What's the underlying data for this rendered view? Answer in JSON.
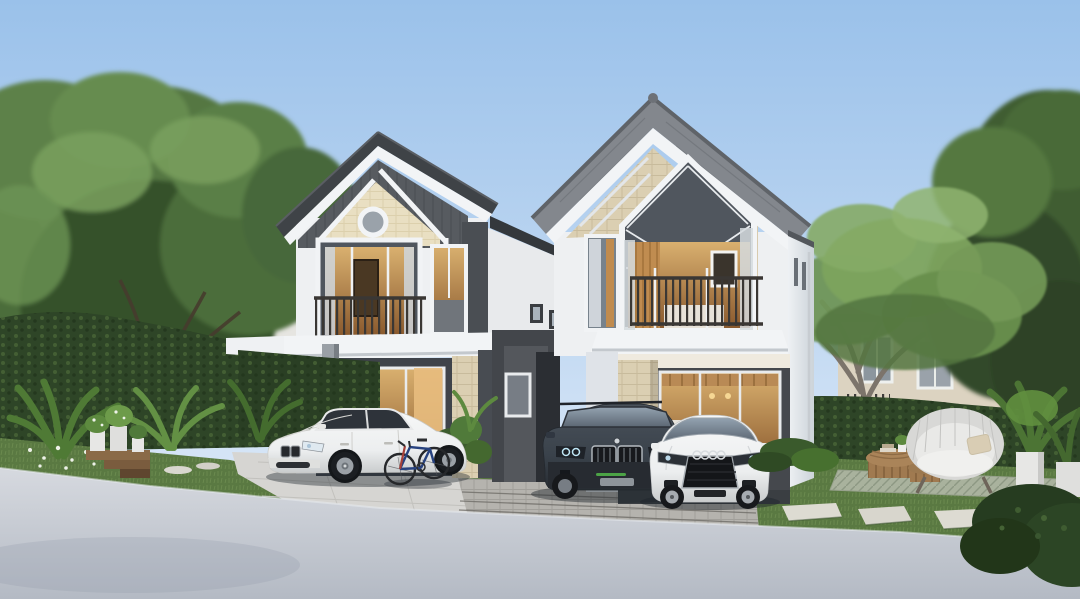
{
  "scene": {
    "title": "Two-storey modern houses — exterior architectural render",
    "setting": "Residential project visualisation at soft dusk light, clear pale-blue sky",
    "houses": [
      {
        "id": "left-house",
        "storeys": 2,
        "roof": "charcoal gable roof with white fascia",
        "gable_accent": "cream shingle panel with round porthole window",
        "features": [
          "second-floor balcony with dark railing",
          "white carport canopy",
          "glass sliding doors with warm interior light",
          "tan tile accent column"
        ]
      },
      {
        "id": "right-house",
        "storeys": 2,
        "roof": "grey tile gable roof with white fascia and ridge caps",
        "gable_accent": "tan brick gable with full-height pentagon feature window",
        "features": [
          "second-floor balcony with dark railing",
          "floor-to-ceiling glazing with warm kitchen interior",
          "tan tile pillar",
          "paver double driveway"
        ]
      }
    ],
    "vehicles": [
      {
        "id": "white-sedan",
        "type": "luxury sedan",
        "color": "white",
        "location": "left house driveway"
      },
      {
        "id": "bicycle",
        "type": "bicycle",
        "color": "blue frame, red fork",
        "location": "leaning beside sedan"
      },
      {
        "id": "dark-suv",
        "type": "compact SUV",
        "color": "dark graphite blue",
        "location": "right house driveway"
      },
      {
        "id": "white-coupe",
        "type": "sports coupe with four-ring grille badge",
        "color": "white",
        "location": "right house driveway"
      }
    ],
    "garden": {
      "left": [
        "clipped hedge wall",
        "tropical leaf plants",
        "wooden step plant stand with white pots",
        "white ground-cover flowers"
      ],
      "right": [
        "lawn with stepping stones",
        "striped outdoor mat",
        "curved wicker sofa with cushion and pillow",
        "two slatted wood coffee tables",
        "potted plants in white cylinder pots",
        "smooth grey ornamental tree"
      ],
      "background": [
        "tall leafy trees",
        "neighbouring houses behind hedges"
      ]
    }
  },
  "colors": {
    "sky_top": "#9ac1ea",
    "sky_mid": "#c2d9f2",
    "sky_horizon": "#e9f1fa",
    "foliage_dark": "#36512b",
    "foliage_mid": "#4c6d3a",
    "foliage_light": "#6f9556",
    "foliage_bright": "#85ab66",
    "hedge": "#2e4527",
    "grass": "#5a7942",
    "grass_light": "#6c8d4f",
    "trunk_grey": "#7c746b",
    "trunk_dark": "#463b2e",
    "roof_dark": "#3f4347",
    "roof_grey": "#83878d",
    "fascia_white": "#f2f4f6",
    "wall_white": "#eef0f2",
    "wall_shaded": "#dde2e7",
    "wall_dark": "#45484d",
    "portal_dark": "#43464b",
    "cream_shingle": "#e9dfc2",
    "tan_brick": "#d8cbae",
    "tan_tile": "#dbcfb2",
    "glass_cool": "#50565e",
    "glass_warm_hi": "#d9b06f",
    "glass_warm_lo": "#8a5a2e",
    "railing": "#3a3734",
    "road_light": "#d6d9df",
    "road_dark": "#b4bac4",
    "paver": "#b5b3ae",
    "paver_joint": "#6f6d68",
    "driveway_light": "#d6d5d2",
    "car_white": "#eceeef",
    "car_dark": "#3a424b",
    "tire": "#1b1e22",
    "stone": "#dddbd2",
    "wood": "#a07a50",
    "rug": "#a9b29d",
    "pot_white": "#e7e7e5",
    "led_green": "#53b84a",
    "led_blue": "#bfe6f5"
  }
}
